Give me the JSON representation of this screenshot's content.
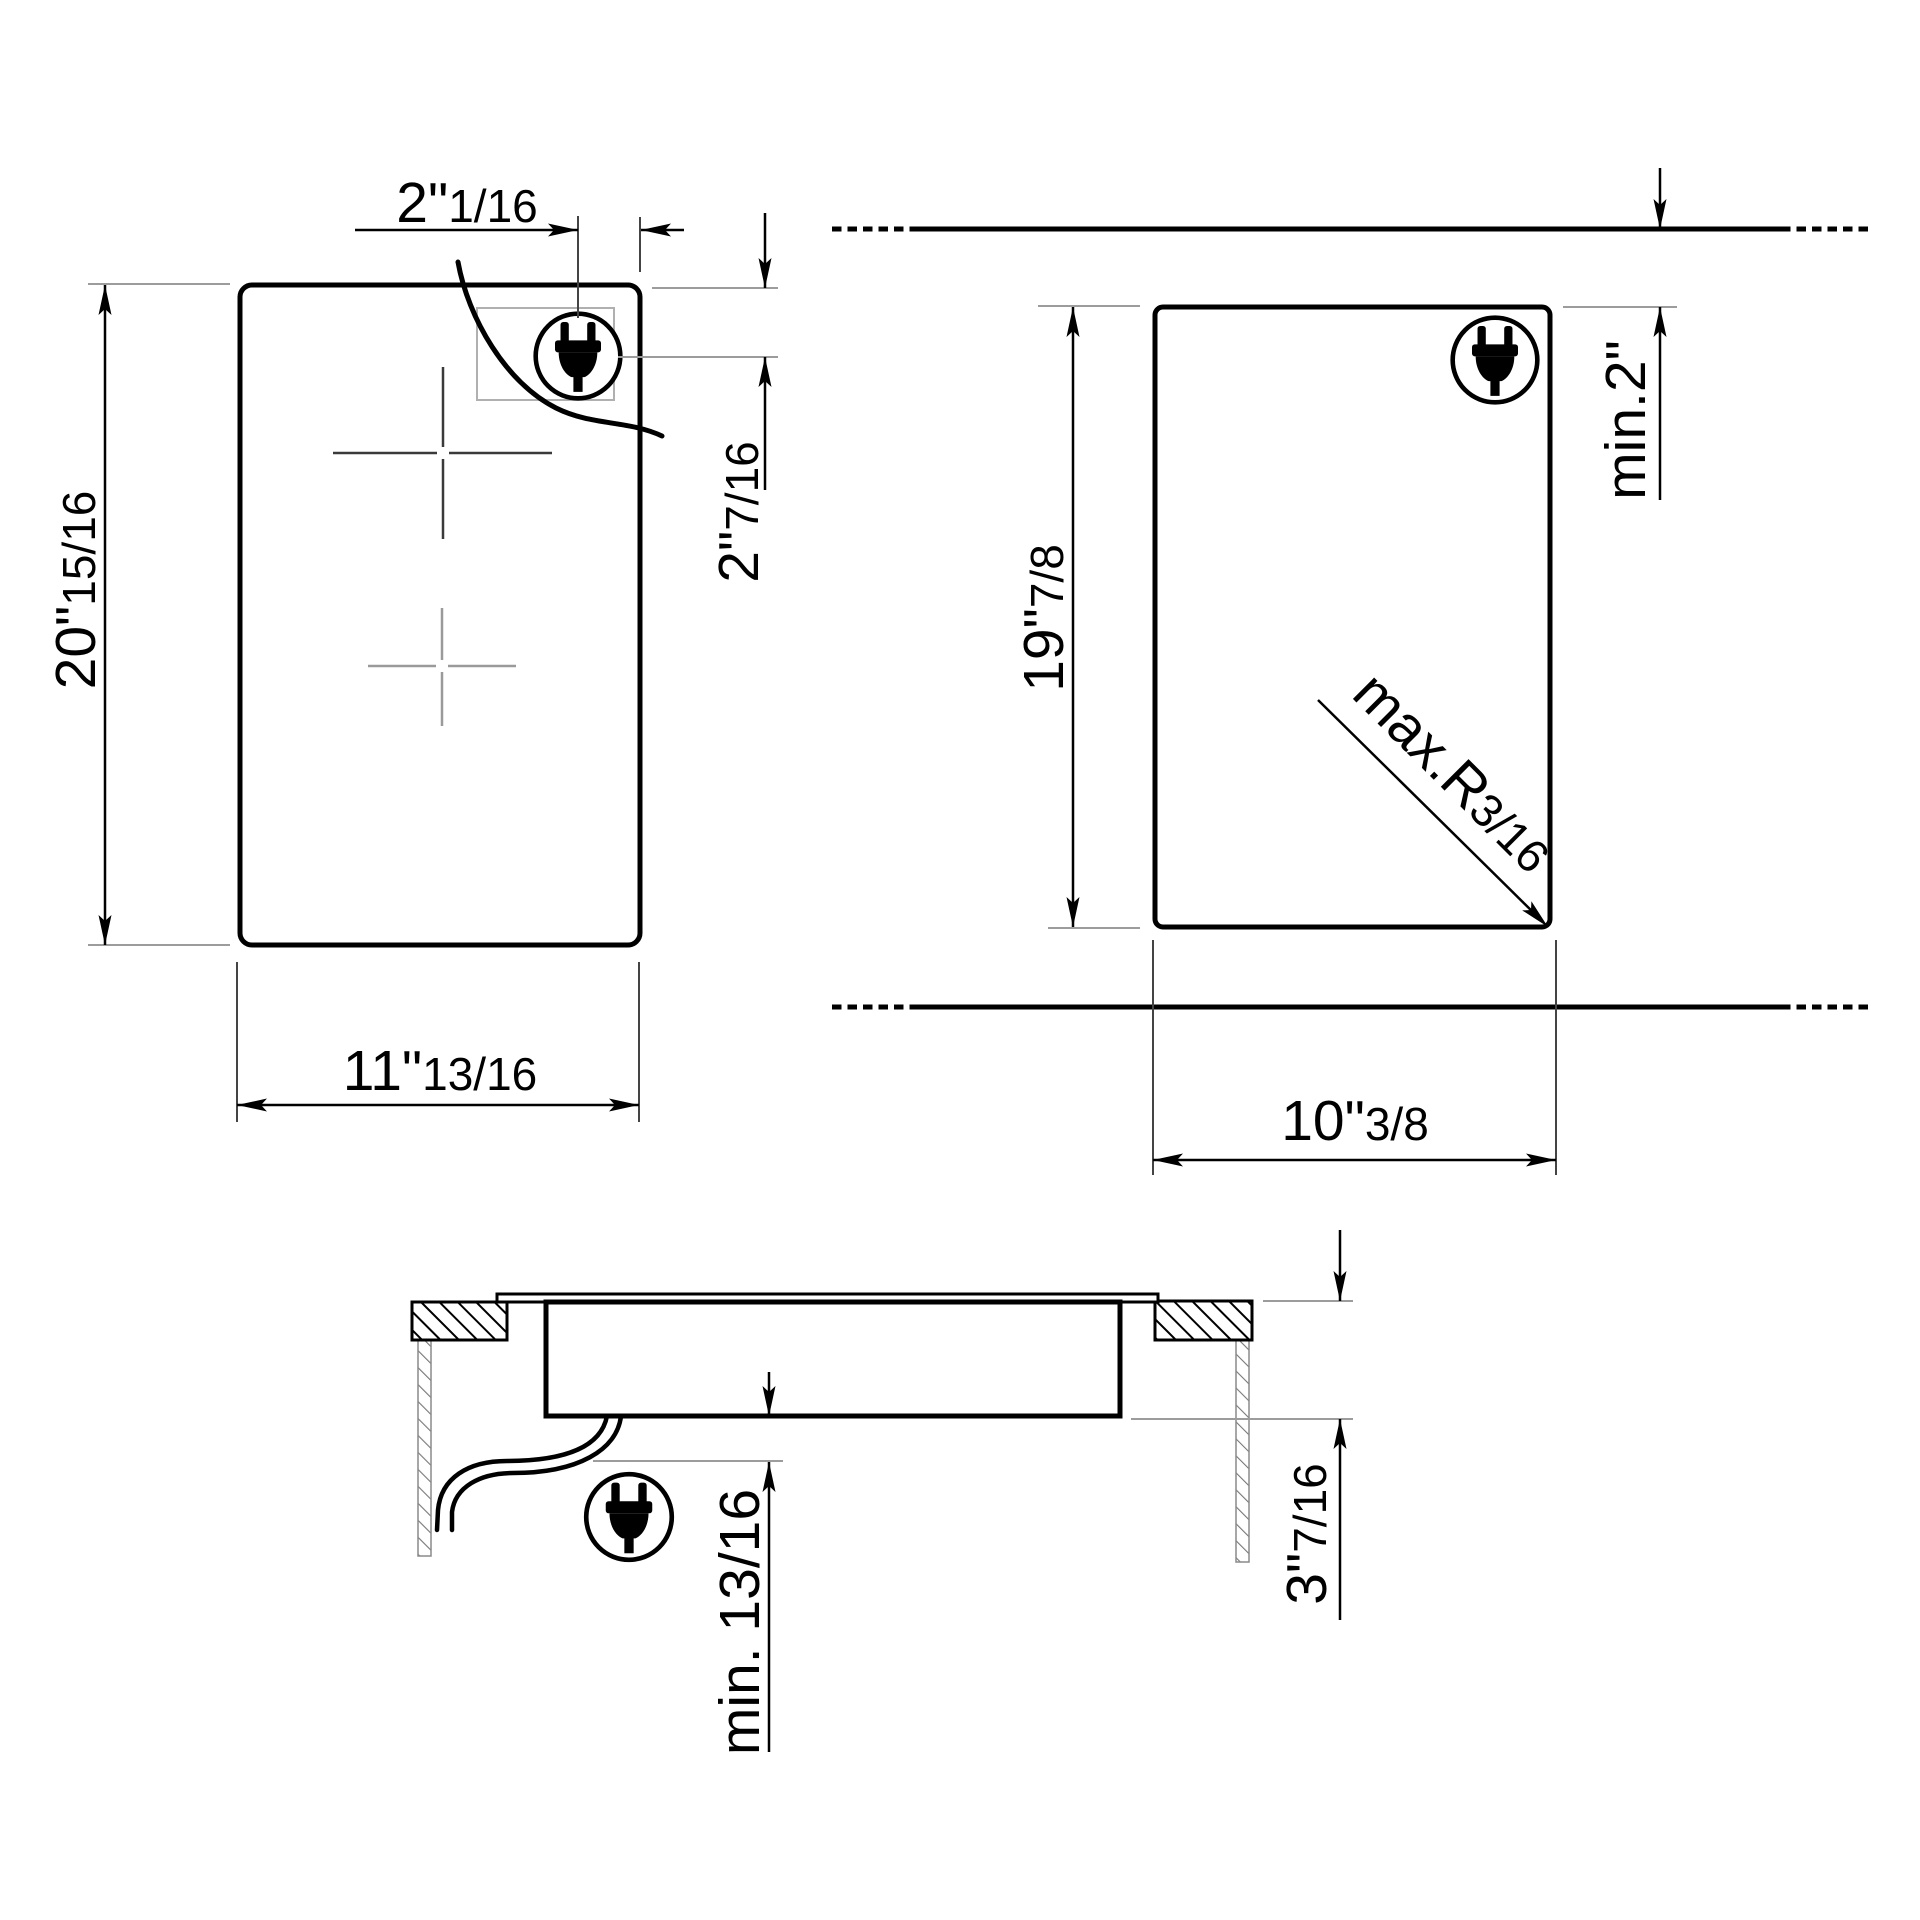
{
  "drawing": {
    "type": "appliance installation dimension drawing",
    "background_color": "#ffffff",
    "line_color": "#000000",
    "reference_line_color": "#9c9c9c",
    "views": {
      "plan": {
        "label": "hob top view",
        "height": {
          "main": "20\"",
          "frac": "15/16"
        },
        "width": {
          "main": "11\"",
          "frac": "13/16"
        },
        "plug_offset_horizontal": {
          "main": "2\"",
          "frac": "1/16"
        },
        "plug_offset_vertical": {
          "main": "2\"",
          "frac": "7/16"
        },
        "icon": "power-plug"
      },
      "cutout": {
        "label": "worktop cutout view",
        "height": {
          "main": "19\"",
          "frac": "7/8"
        },
        "width": {
          "main": "10\"",
          "frac": "3/8"
        },
        "rear_clearance": {
          "main": "min.2\"",
          "frac": ""
        },
        "corner_radius": {
          "main": "max.R",
          "frac": "3/16"
        },
        "icon": "power-plug"
      },
      "section": {
        "label": "side section view",
        "bottom_clearance": {
          "main": "min. 13/16",
          "frac": ""
        },
        "installed_depth": {
          "main": "3\"",
          "frac": "7/16"
        },
        "icon": "power-plug"
      }
    }
  }
}
